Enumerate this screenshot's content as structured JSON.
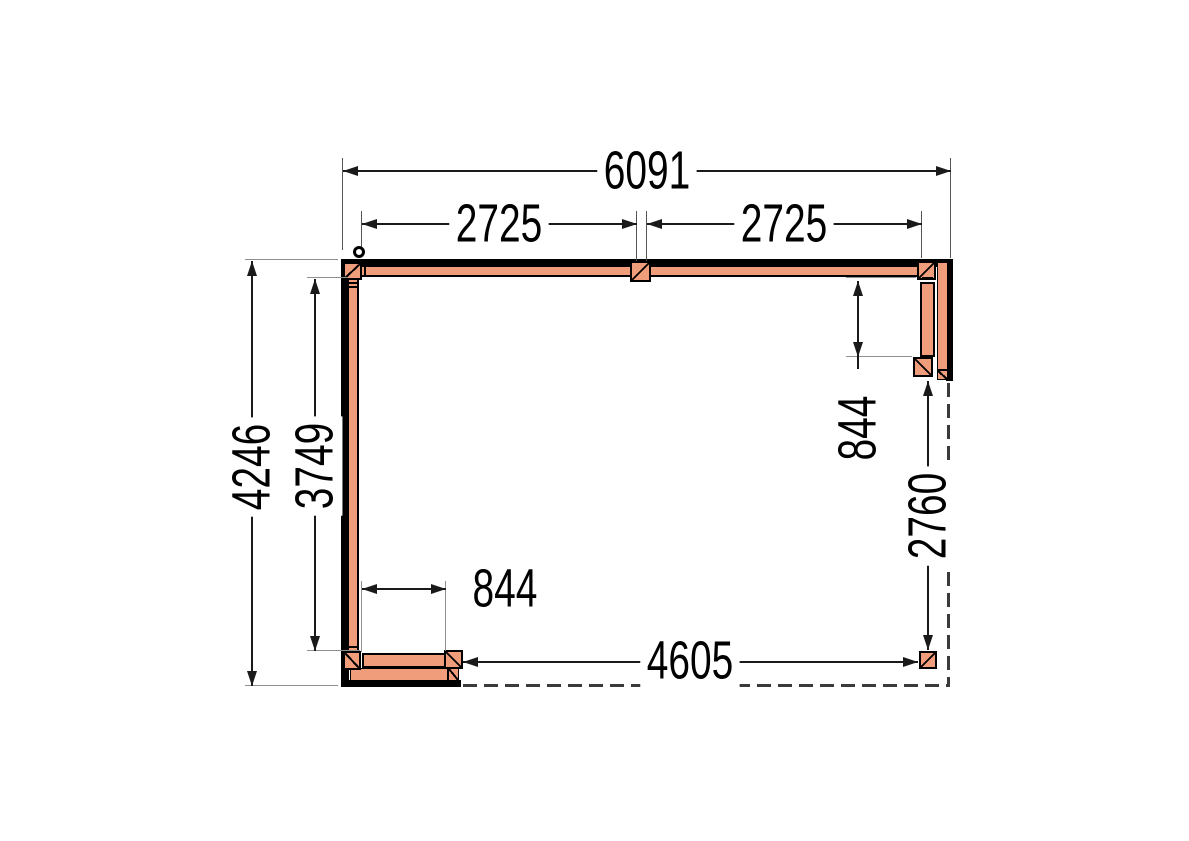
{
  "drawing": {
    "type": "veranda-floor-plan",
    "unit": "mm",
    "colors": {
      "wood": "#EF9D7B",
      "outline": "#000000",
      "dim_line": "#1a1a1a",
      "ext_line": "#8f8f8f",
      "dashed_line": "#3a3a3a",
      "text": "#000000",
      "background": "#ffffff"
    },
    "dimensions": {
      "overall_width": "6091",
      "bay_left": "2725",
      "bay_right": "2725",
      "overall_depth": "4246",
      "inner_depth": "3749",
      "right_wall_length": "844",
      "right_open_length": "2760",
      "bottom_wall_length": "844",
      "bottom_open_length": "4605"
    }
  }
}
